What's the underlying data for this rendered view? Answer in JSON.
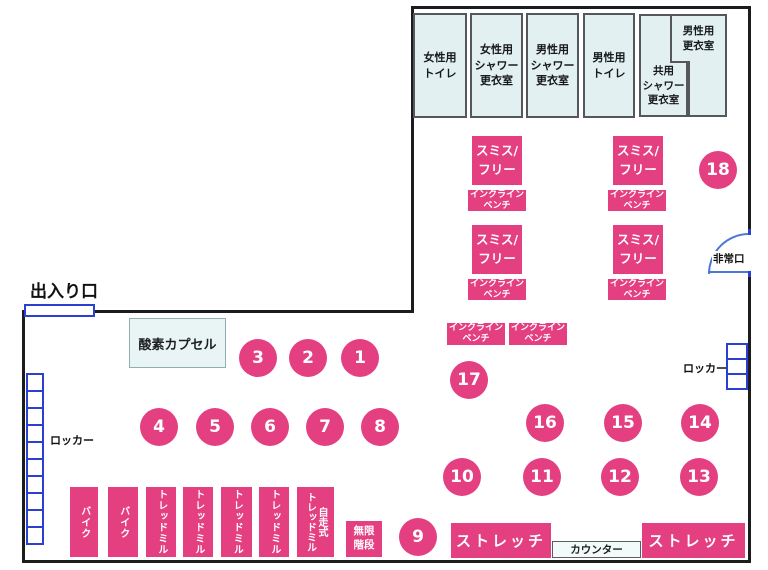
{
  "map": {
    "entrance_label": "出入り口",
    "emergency_exit_label": "非常口",
    "locker_label": "ロッカー",
    "oxygen_capsule_label": "酸素カプセル",
    "counter_label": "カウンター",
    "infinite_stairs_label": "無限\n階段",
    "stretch_label": "ストレッチ",
    "smith_free_label": "スミス/\nフリー",
    "incline_bench_label": "インクライン\nベンチ",
    "rooms": [
      "女性用\nトイレ",
      "女性用\nシャワー\n更衣室",
      "男性用\nシャワー\n更衣室",
      "男性用\nトイレ",
      "共用\nシャワー\n更衣室",
      "男性用\n更衣室"
    ],
    "machines": [
      "バイク",
      "バイク",
      "トレッドミル",
      "トレッドミル",
      "トレッドミル",
      "トレッドミル",
      "自走式\nトレッドミル"
    ],
    "station_numbers": [
      "1",
      "2",
      "3",
      "4",
      "5",
      "6",
      "7",
      "8",
      "9",
      "10",
      "11",
      "12",
      "13",
      "14",
      "15",
      "16",
      "17",
      "18"
    ]
  },
  "colors": {
    "accent_pink": "#e43f81",
    "room_fill": "#e2f0f1",
    "room_border": "#54585c",
    "wall_black": "#1c1c1e",
    "locker_blue": "#2b3fd0",
    "door_arc_blue": "#4a77d8"
  }
}
